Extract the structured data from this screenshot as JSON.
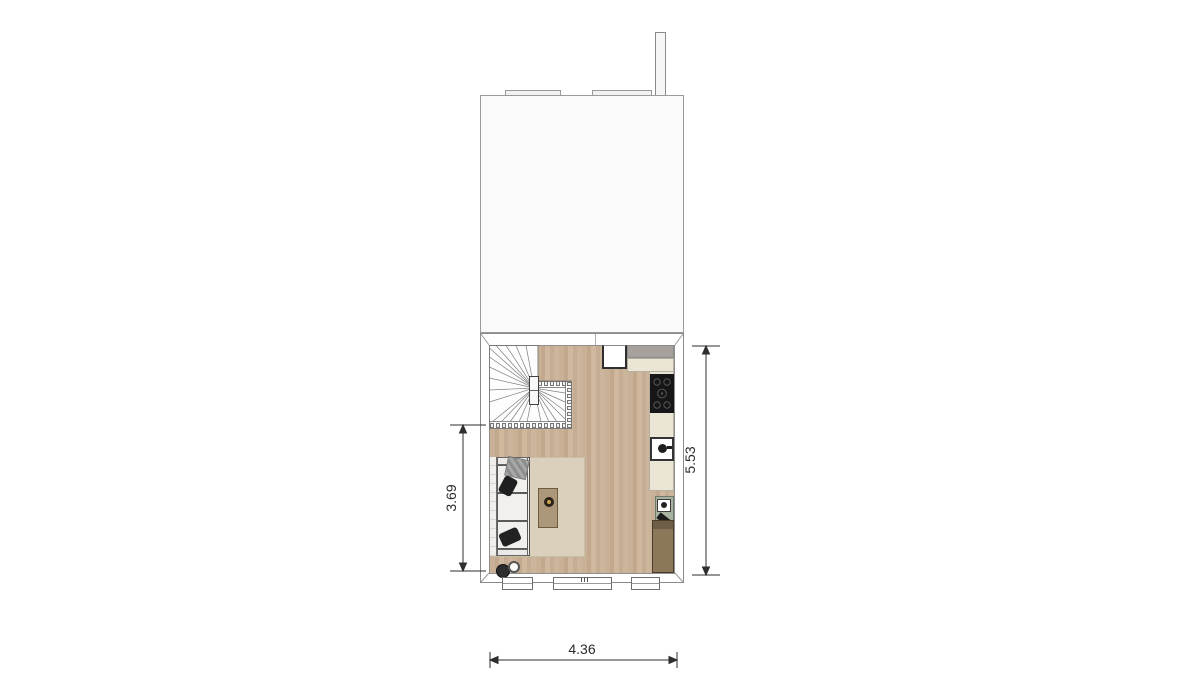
{
  "plan": {
    "type": "floor-plan",
    "dimension_labels": {
      "left": "3.69",
      "right": "5.53",
      "bottom": "4.36"
    },
    "colors": {
      "background": "#ffffff",
      "wall_line": "#8f8f8f",
      "upper_area": "#fafafa",
      "wood_floor": "#c8b096",
      "rug": "#dbd0bc",
      "kitchen_counter_gray": "#a6a19b",
      "kitchen_counter_cream": "#ebe5d5",
      "cooktop": "#161616",
      "tall_cabinet": "#8c7759",
      "sideboard_green": "#a7b2a0",
      "coffee_table": "#ac977a",
      "dimension_ink": "#2e2e2e"
    },
    "objects": [
      "chimney",
      "upper-floor-area",
      "roof-window-left",
      "roof-window-right",
      "winder-staircase",
      "fridge",
      "kitchen-counter",
      "cooktop",
      "kitchen-sink",
      "rug",
      "sofa",
      "coffee-table",
      "pouf-dark",
      "pouf-light",
      "green-sideboard",
      "tall-cabinet",
      "window-left",
      "window-center",
      "window-right"
    ]
  }
}
